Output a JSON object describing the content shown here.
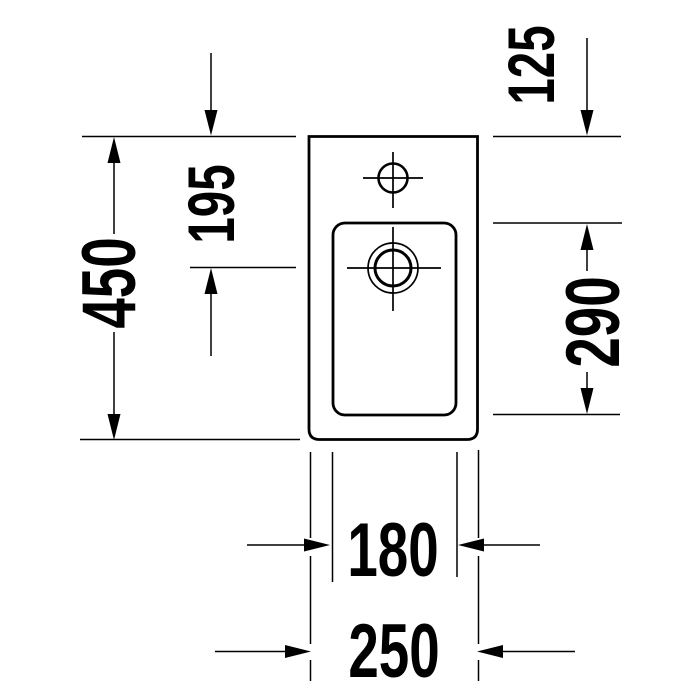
{
  "drawing": {
    "background_color": "#ffffff",
    "line_color": "#000000",
    "view": "washbasin-plan-view-technical-drawing"
  },
  "dimension_labels": {
    "left": "450",
    "upper_middle": "195",
    "upper_right": "125",
    "right": "290",
    "bottom_inner": "180",
    "bottom_outer": "250"
  }
}
